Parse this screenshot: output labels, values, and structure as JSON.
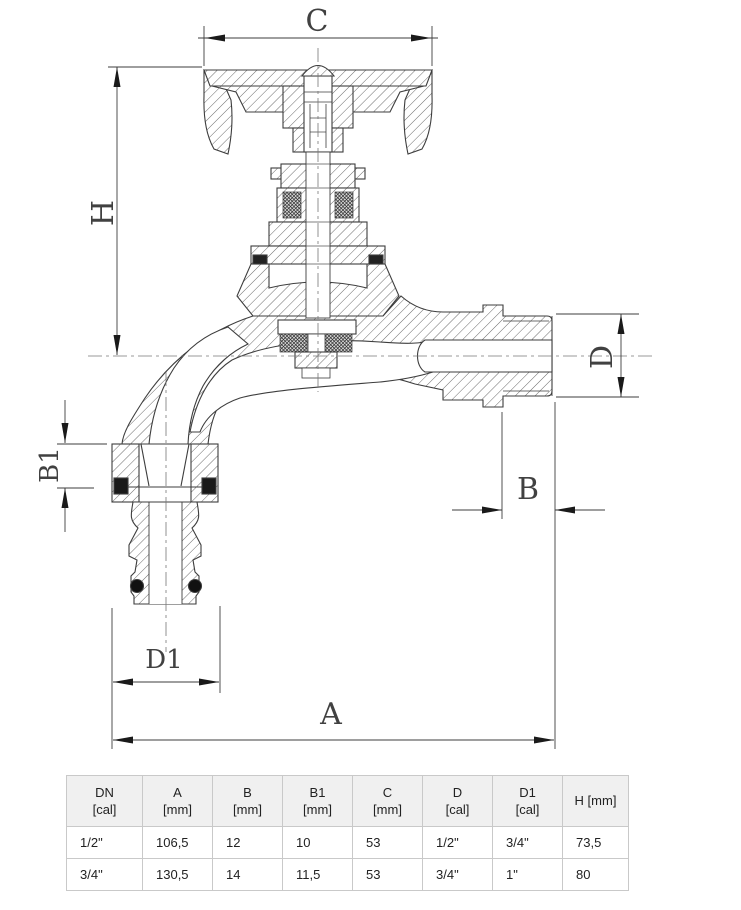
{
  "drawing": {
    "dims": {
      "c": "C",
      "h": "H",
      "d": "D",
      "b": "B",
      "b1": "B1",
      "d1": "D1",
      "a": "A"
    }
  },
  "table": {
    "headers": [
      {
        "main": "DN",
        "sub": "[cal]"
      },
      {
        "main": "A",
        "sub": "[mm]"
      },
      {
        "main": "B",
        "sub": "[mm]"
      },
      {
        "main": "B1",
        "sub": "[mm]"
      },
      {
        "main": "C",
        "sub": "[mm]"
      },
      {
        "main": "D",
        "sub": "[cal]"
      },
      {
        "main": "D1",
        "sub": "[cal]"
      },
      {
        "main": "H [mm]",
        "sub": ""
      }
    ],
    "rows": [
      [
        "1/2\"",
        "106,5",
        "12",
        "10",
        "53",
        "1/2\"",
        "3/4\"",
        "73,5"
      ],
      [
        "3/4\"",
        "130,5",
        "14",
        "11,5",
        "53",
        "3/4\"",
        "1\"",
        "80"
      ]
    ]
  },
  "colors": {
    "line": "#3d3d3d",
    "hatch": "#6b6b6b",
    "table_border": "#c9c9c9",
    "header_bg": "#f0f0f0",
    "text": "#222222"
  }
}
